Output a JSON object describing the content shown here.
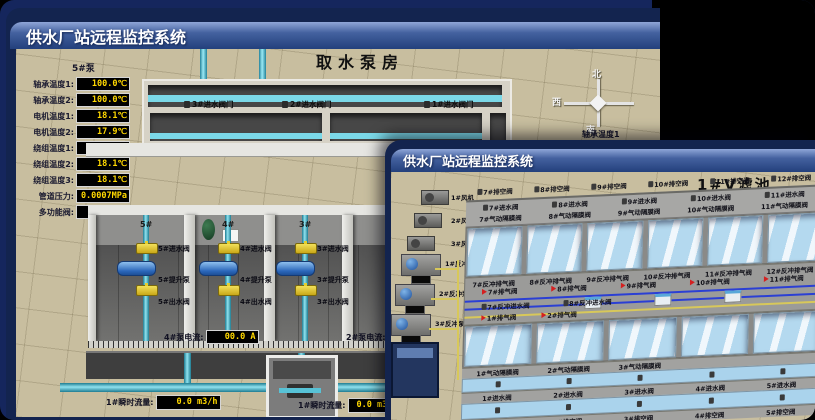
{
  "colors": {
    "canvas_bg": "#15265d",
    "titlebar_top": "#8fa6d8",
    "titlebar_bottom": "#23407c",
    "scene_bg": "#c8be9f",
    "readout_text": "#ffd800",
    "water": "#b4d9ef",
    "pipe_cyan": "#7bd8e8",
    "valve_yellow": "#e6cf2e",
    "alarm_red": "#d42020"
  },
  "icons": {
    "compass": "cross-star",
    "valve_small": "gray-valve-glyph",
    "valve_yellow": "butterfly-valve",
    "red_flag": "alarm-marker",
    "pump": "motor-capsule",
    "flow_meter": "meter-cabinet"
  },
  "back_window": {
    "titlebar": {
      "title": "供水厂站远程监控系统"
    },
    "scene_title": "取水泵房",
    "pump_panel": {
      "header": "5#泵",
      "readings": [
        {
          "label": "轴承温度1:",
          "value": "100.0℃"
        },
        {
          "label": "轴承温度2:",
          "value": "100.0℃"
        },
        {
          "label": "电机温度1:",
          "value": "18.1℃"
        },
        {
          "label": "电机温度2:",
          "value": "17.9℃"
        },
        {
          "label": "绕组温度1:",
          "value": "18.0℃"
        },
        {
          "label": "绕组温度2:",
          "value": "18.1℃"
        },
        {
          "label": "绕组温度3:",
          "value": "18.1℃"
        },
        {
          "label": "管道压力:",
          "value": "0.0007MPa"
        },
        {
          "label": "多功能阀:",
          "value": "0%"
        }
      ]
    },
    "intake_valves": [
      "3#进水阀门",
      "2#进水阀门",
      "1#进水阀门"
    ],
    "compass": {
      "north": "北",
      "west": "西",
      "south": "南"
    },
    "right_panel_labels": [
      "轴承温度1",
      "轴承温度2"
    ],
    "pump_bays": [
      {
        "bay": "5#",
        "inlet": "5#进水阀",
        "pump": "5#提升泵",
        "outlet": "5#出水阀"
      },
      {
        "bay": "4#",
        "inlet": "4#进水阀",
        "pump": "4#提升泵",
        "outlet": "4#出水阀"
      },
      {
        "bay": "3#",
        "inlet": "3#进水阀",
        "pump": "3#提升泵",
        "outlet": "3#出水阀"
      }
    ],
    "current_left": {
      "label": "4#泵电流:",
      "value": "00.0 A"
    },
    "current_right": {
      "label": "2#泵电流:"
    },
    "flow_left": {
      "label": "1#瞬时流量:",
      "value": "0.0 m3/h"
    },
    "flow_right": {
      "label": "1#瞬时流量:",
      "value": "0.0 m3/h"
    }
  },
  "front_window": {
    "titlebar": {
      "title": "供水厂站远程监控系统"
    },
    "scene_title": "1#V滤池",
    "blowers": [
      "1#风机",
      "2#风机",
      "3#风机"
    ],
    "backwash_pumps": [
      "1#反冲泵",
      "2#反冲泵",
      "3#反冲泵"
    ],
    "top_drain_valves": [
      "7#排空阀",
      "8#排空阀",
      "9#排空阀",
      "10#排空阀",
      "11#排空阀",
      "12#排空阀"
    ],
    "top_inlet_valves": [
      "7#进水阀",
      "8#进水阀",
      "9#进水阀",
      "10#进水阀",
      "11#进水阀"
    ],
    "top_diaphragm_valves": [
      "7#气动隔膜阀",
      "8#气动隔膜阀",
      "9#气动隔膜阀",
      "10#气动隔膜阀",
      "11#气动隔膜阀"
    ],
    "mid_backwash_exhaust_valves": [
      "7#反冲排气阀",
      "8#反冲排气阀",
      "9#反冲排气阀",
      "10#反冲排气阀",
      "11#反冲排气阀",
      "12#反冲排气阀"
    ],
    "mid_exhaust_valves": [
      "7#排气阀",
      "8#排气阀",
      "9#排气阀",
      "10#排气阀",
      "11#排气阀"
    ],
    "mid_backwash_inlet_valves": [
      "7#反冲进水阀",
      "8#反冲进水阀"
    ],
    "bottom_exhaust_valves": [
      "1#排气阀",
      "2#排气阀"
    ],
    "bottom_diaphragm_valves": [
      "1#气动隔膜阀",
      "2#气动隔膜阀",
      "3#气动隔膜阀"
    ],
    "bottom_inlet_valves": [
      "1#进水阀",
      "2#进水阀",
      "3#进水阀",
      "4#进水阀",
      "5#进水阀"
    ],
    "bottom_drain_valves": [
      "1#排空阀",
      "2#排空阀",
      "3#排空阀",
      "4#排空阀",
      "5#排空阀"
    ]
  }
}
